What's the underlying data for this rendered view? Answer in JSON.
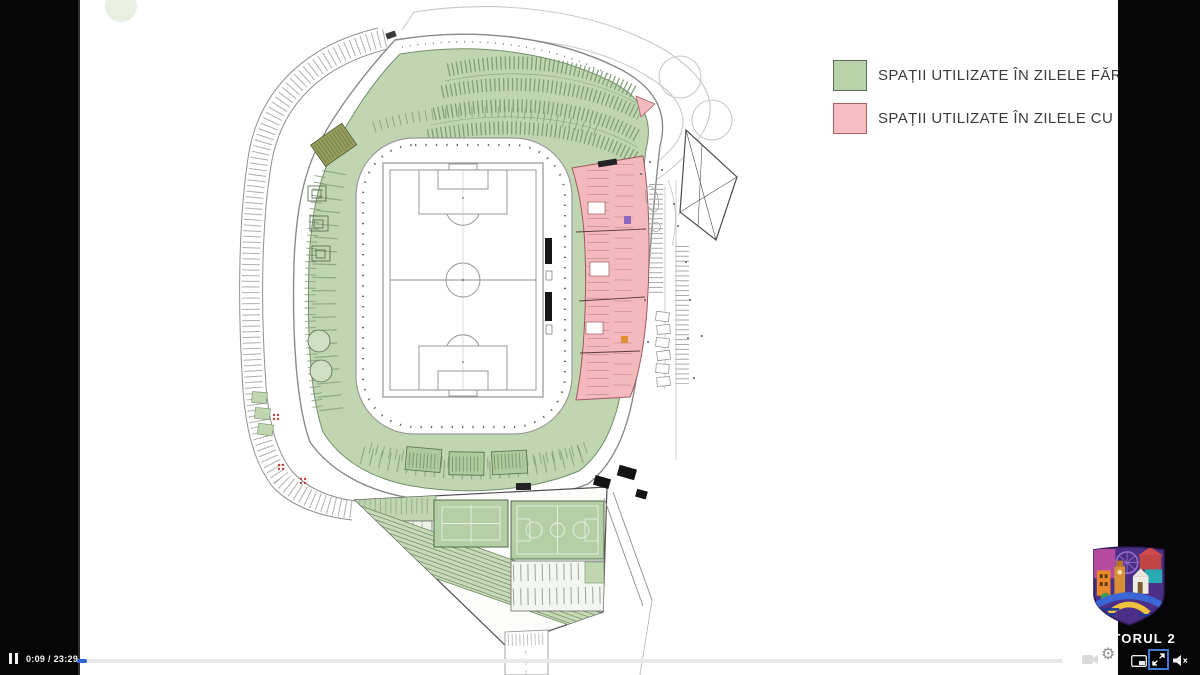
{
  "frame": {
    "type": "letterboxed-video-player",
    "letterbox_color": "#060606",
    "slide_background": "#ffffff"
  },
  "player": {
    "state": "playing",
    "time_display": "0:09 / 23:29",
    "current_time": "0:09",
    "duration": "23:29",
    "progress_percent": 0.64,
    "accent_color": "#2e63d0",
    "icons": {
      "pause": "pause-icon",
      "camera": "video-camera-icon",
      "settings": "settings-gear-icon",
      "settings_glyph": "⚙",
      "pip": "picture-in-picture-icon",
      "fullscreen": "exit-fullscreen-icon",
      "volume": "volume-muted-icon"
    }
  },
  "slide": {
    "plan": {
      "name": "stadium-ground-floor-plan",
      "no_match_day_color": "#bfd6b0",
      "match_day_color": "#f3b9bd"
    },
    "legend": {
      "items": [
        {
          "label": "SPAȚII UTILIZATE ÎN ZILELE FĂRĂ MECI",
          "swatch_color": "#b8d2aa",
          "swatch_border": "#5d6b57"
        },
        {
          "label": "SPAȚII UTILIZATE ÎN ZILELE CU MECI",
          "swatch_color": "#f8bdc2",
          "swatch_border": "#a96067"
        }
      ]
    },
    "logo": {
      "text": "SECTORUL 2"
    }
  }
}
